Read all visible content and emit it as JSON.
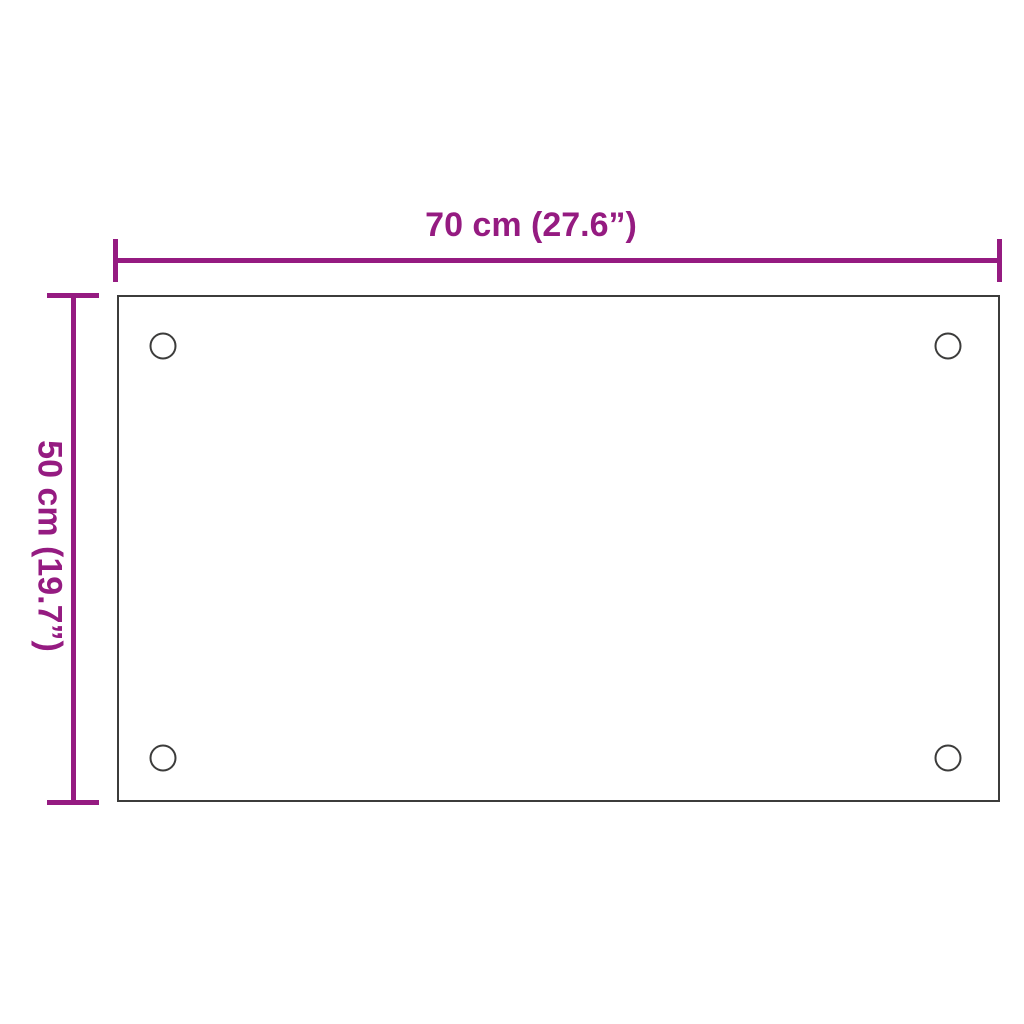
{
  "figure": {
    "type": "product-dimension-diagram",
    "width_dimension": {
      "label": "70 cm (27.6”)"
    },
    "height_dimension": {
      "label": "50 cm (19.7”)"
    },
    "panel": {
      "shape": "rectangle",
      "mounting_holes_count": 4
    },
    "colors": {
      "dimension_accent": "#951b81",
      "panel_outline": "#3c3c3b",
      "background": "#ffffff"
    }
  }
}
